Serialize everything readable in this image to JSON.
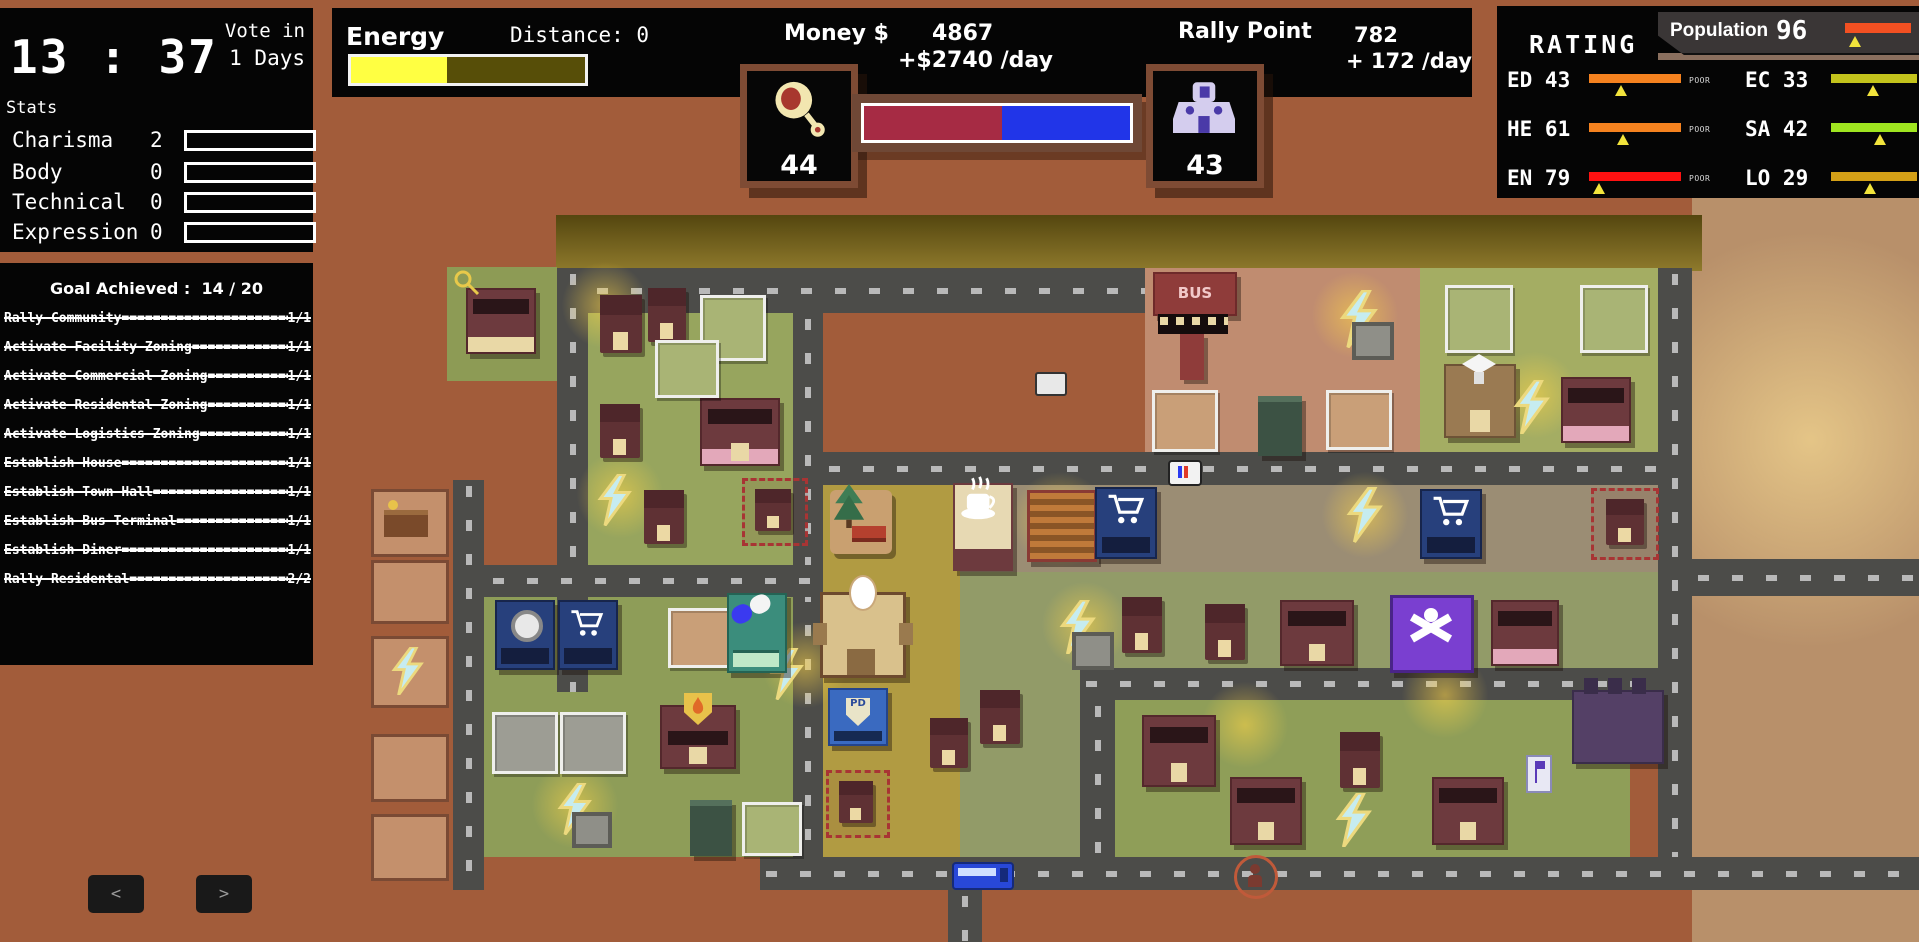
{
  "clock_panel": {
    "time": "13 : 37",
    "vote_line1": "Vote in",
    "vote_line2": "1 Days",
    "stats_title": "Stats",
    "stats": [
      {
        "label": "Charisma",
        "value": "2",
        "fill": 7
      },
      {
        "label": "Body",
        "value": "0",
        "fill": 0
      },
      {
        "label": "Technical",
        "value": "0",
        "fill": 0
      },
      {
        "label": "Expression",
        "value": "0",
        "fill": 0
      }
    ]
  },
  "goals_panel": {
    "title_label": "Goal Achieved :",
    "title_value": "14 / 20",
    "filler": "==========================================",
    "goals": [
      {
        "name": "Rally Community",
        "progress": "1/1"
      },
      {
        "name": "Activate Facility Zoning",
        "progress": "1/1"
      },
      {
        "name": "Activate Commercial Zoning",
        "progress": "1/1"
      },
      {
        "name": "Activate Residental Zoning",
        "progress": "1/1"
      },
      {
        "name": "Activate Logistics Zoning",
        "progress": "1/1"
      },
      {
        "name": "Establish House",
        "progress": "1/1"
      },
      {
        "name": "Establish Town Hall",
        "progress": "1/1"
      },
      {
        "name": "Establish Bus Terminal",
        "progress": "1/1"
      },
      {
        "name": "Establish Diner",
        "progress": "1/1"
      },
      {
        "name": "Rally Residental",
        "progress": "2/2"
      }
    ],
    "prev_label": "<",
    "next_label": ">"
  },
  "top_bar": {
    "energy_label": "Energy",
    "energy_fill": 41,
    "energy_color": "#ffff42",
    "distance_label": "Distance:  0",
    "money_label": "Money $",
    "money_value": "4867",
    "money_rate": "+$2740 /day",
    "rally_label": "Rally Point",
    "rally_value": "782",
    "rally_rate": "+ 172 /day",
    "left_counter": "44",
    "right_counter": "43",
    "balance_red": 52,
    "red_color": "#a62b44",
    "blue_color": "#2135e8"
  },
  "rating_panel": {
    "title": "RATING",
    "population_label": "Population",
    "population_value": "96",
    "population_color": "#f25022",
    "population_marker": 8,
    "ratings": [
      {
        "code": "ED 43",
        "status": "POOR",
        "color": "#f5821f",
        "marker": 28
      },
      {
        "code": "EC 33",
        "status": "MARGINAL",
        "color": "#c3c31c",
        "marker": 42
      },
      {
        "code": "HE 61",
        "status": "POOR",
        "color": "#f5821f",
        "marker": 30
      },
      {
        "code": "SA 42",
        "status": "ADEQUATE",
        "color": "#9fe520",
        "marker": 50
      },
      {
        "code": "EN 79",
        "status": "POOR",
        "color": "#ff1111",
        "marker": 4
      },
      {
        "code": "LO 29",
        "status": "MARGINAL",
        "color": "#d4a017",
        "marker": 38
      }
    ]
  },
  "map": {
    "bus_sign": "BUS",
    "pd_label": "PD"
  }
}
